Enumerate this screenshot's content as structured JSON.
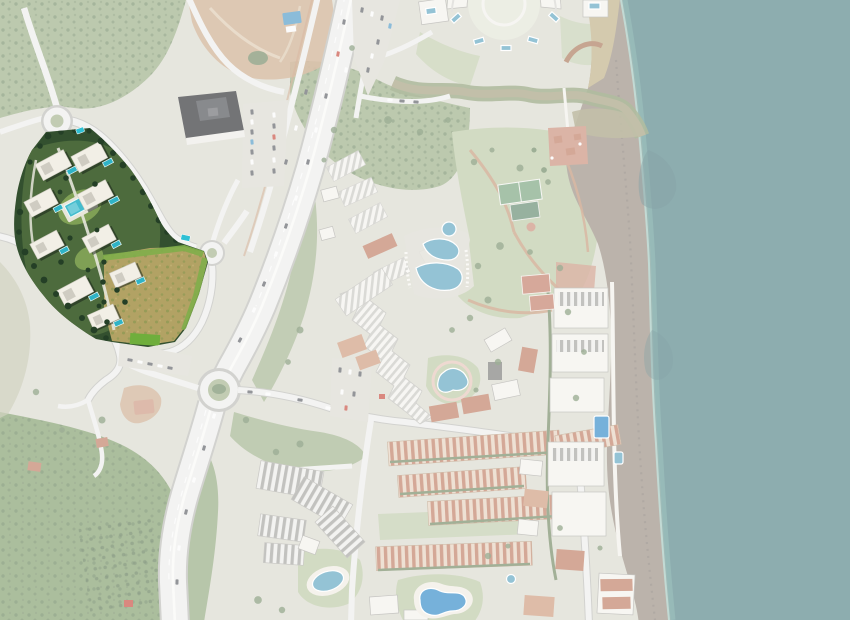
{
  "meta": {
    "kind": "aerial-satellite-map",
    "description": "Washed-out aerial photograph of a Mediterranean coastal resort town with a fully saturated 3D master-plan render of a new residential development highlighted at the upper left, a dry tan plot beside it, a motorway with roundabouts, a beach resort with pools and tennis courts in the centre, townhouse rows at the bottom and the sea along the right edge.",
    "width": 850,
    "height": 620
  },
  "overlay": {
    "wash_opacity": 0.4
  },
  "colors": {
    "land": "#d6d5c9",
    "forestA": "#8fa578",
    "forestB": "#74935c",
    "scrub": "#b4b698",
    "lawnWash": "#b5c49c",
    "dirt": "#c49a74",
    "dirtTrack": "#e0cdb2",
    "sea": "#42777b",
    "seaShallow": "#56918d",
    "foam": "#9fc8bc",
    "beach": "#8e8174",
    "sand": "#b8a778",
    "dune": "#6e655c",
    "roadFill": "#ececea",
    "roadCase": "#b4b5af",
    "islandGreen": "#9aab80",
    "pathTan": "#c08a66",
    "pavement": "#d8d6cc",
    "bldgWhite": "#f2f0ea",
    "bldgShadow": "#a2a19b",
    "roofTerra": "#b86e52",
    "roofTerraLight": "#c98f6e",
    "darkRoof": "#17181c",
    "poolWash": "#4d9cba",
    "poolBright": "#1c7ec2",
    "courtGreen": "#6b9a70",
    "courtDark": "#527e60",
    "clay": "#bb6e58",
    "river": "#9a9570",
    "riverBank": "#7c8f60",
    "carDark": "#4c4f55",
    "carWhite": "#fafafa",
    "carRed": "#c03a2a",
    "carBlue": "#3f8fc0",
    "treeWash": "#5d7a50",
    "hedge": "#647c52",
    "redPaved": "#c4826c",
    "pergola": "#a06a48",
    "promenade": "#f1efe8",
    "devBase": "#33502f",
    "devGreen": "#4d6b3d",
    "devLawn": "#7fa055",
    "devLawnBright": "#6fae3c",
    "devTree": "#243f26",
    "devBldg": "#f2efe6",
    "devRoof": "#cfccc2",
    "devShadow": "#1a2419",
    "devPool": "#2fb3c6",
    "devPoolMain": "#45bccd",
    "devPath": "#e6e5da",
    "busStop": "#2fc0d4",
    "field": "#b2a264",
    "fieldSpeckle": "#8f9a54",
    "fieldBuffer": "#7fae4a"
  },
  "features": [
    {
      "name": "development-plot",
      "note": "saturated 3D render of new residential complex, 9 white apartment blocks with private pools",
      "bbox": [
        14,
        126,
        196,
        222
      ]
    },
    {
      "name": "development-central-pool",
      "note": "large turquoise communal pool on lawn",
      "bbox": [
        62,
        192,
        36,
        26
      ]
    },
    {
      "name": "dry-field-plot",
      "note": "tan undeveloped parcel inside highlighted plot",
      "bbox": [
        102,
        246,
        106,
        100
      ]
    },
    {
      "name": "northwest-roundabout",
      "note": "roundabout at development entrance",
      "bbox": [
        42,
        106,
        30,
        30
      ]
    },
    {
      "name": "development-roundabout",
      "note": "small roundabout east of dry field",
      "bbox": [
        200,
        241,
        24,
        24
      ]
    },
    {
      "name": "main-roundabout",
      "note": "large roundabout on coastal motorway",
      "bbox": [
        197,
        368,
        44,
        44
      ]
    },
    {
      "name": "motorway",
      "note": "dual carriageway running from top centre to bottom left",
      "bbox": [
        170,
        0,
        190,
        620
      ]
    },
    {
      "name": "dark-roof-building",
      "note": "large commercial building with near-black roof and parking",
      "bbox": [
        176,
        90,
        70,
        52
      ]
    },
    {
      "name": "north-dirt-lot",
      "note": "reddish cleared ground, top edge",
      "bbox": [
        186,
        0,
        148,
        84
      ]
    },
    {
      "name": "crescent-building",
      "note": "semi-circular apartment building with rooftop pools and round courtyard garden",
      "bbox": [
        440,
        0,
        130,
        70
      ]
    },
    {
      "name": "river",
      "note": "stream flowing east into the sea through a sandy mouth",
      "bbox": [
        390,
        76,
        255,
        64
      ]
    },
    {
      "name": "beach-bar",
      "note": "red-tiled chiringuito terrace on the beach",
      "bbox": [
        546,
        126,
        42,
        42
      ]
    },
    {
      "name": "resort-lawn",
      "note": "large pale lawn with winding pink paths",
      "bbox": [
        452,
        126,
        150,
        195
      ]
    },
    {
      "name": "tennis-courts-green",
      "note": "two green courts near beach",
      "bbox": [
        496,
        176,
        48,
        46
      ]
    },
    {
      "name": "clay-courts",
      "note": "two red clay courts",
      "bbox": [
        518,
        272,
        38,
        42
      ]
    },
    {
      "name": "resort-main-pool",
      "note": "irregular twin-lobe swimming pool with sun deck",
      "bbox": [
        410,
        224,
        66,
        72
      ]
    },
    {
      "name": "resort-lagoon-pool",
      "note": "small lagoon pool ringed by pink path",
      "bbox": [
        432,
        362,
        42,
        36
      ]
    },
    {
      "name": "hotel-zigzag-building",
      "note": "stepped terraced hotel block running diagonally",
      "bbox": [
        330,
        282,
        106,
        148
      ]
    },
    {
      "name": "apartment-rows-white",
      "note": "curved rows of white/grey apartment blocks",
      "bbox": [
        254,
        458,
        120,
        110
      ]
    },
    {
      "name": "townhouse-rows",
      "note": "parallel rows of terracotta-roofed townhouses",
      "bbox": [
        372,
        415,
        250,
        160
      ]
    },
    {
      "name": "south-pool-oval",
      "note": "oval community pool in garden",
      "bbox": [
        306,
        564,
        50,
        34
      ]
    },
    {
      "name": "south-lagoon-pool",
      "note": "bright blue lagoon-shaped pool",
      "bbox": [
        412,
        582,
        62,
        40
      ]
    },
    {
      "name": "beachfront-buildings",
      "note": "strip of apartment blocks along the beach",
      "bbox": [
        540,
        270,
        80,
        300
      ]
    },
    {
      "name": "beachfront-pool",
      "note": "rectangular blue pool behind beach block",
      "bbox": [
        592,
        414,
        18,
        26
      ]
    },
    {
      "name": "beach",
      "note": "grey sand beach narrowing to the north",
      "bbox": [
        560,
        0,
        110,
        620
      ]
    },
    {
      "name": "sea",
      "note": "muted teal Mediterranean sea",
      "bbox": [
        615,
        0,
        235,
        620
      ]
    },
    {
      "name": "southwest-forest",
      "note": "dense green woodland with orchard rows",
      "bbox": [
        0,
        408,
        190,
        212
      ]
    },
    {
      "name": "bus-stops",
      "note": "two cyan bus-stop shelters on development ring road",
      "bbox": [
        76,
        128,
        116,
        116
      ]
    }
  ]
}
